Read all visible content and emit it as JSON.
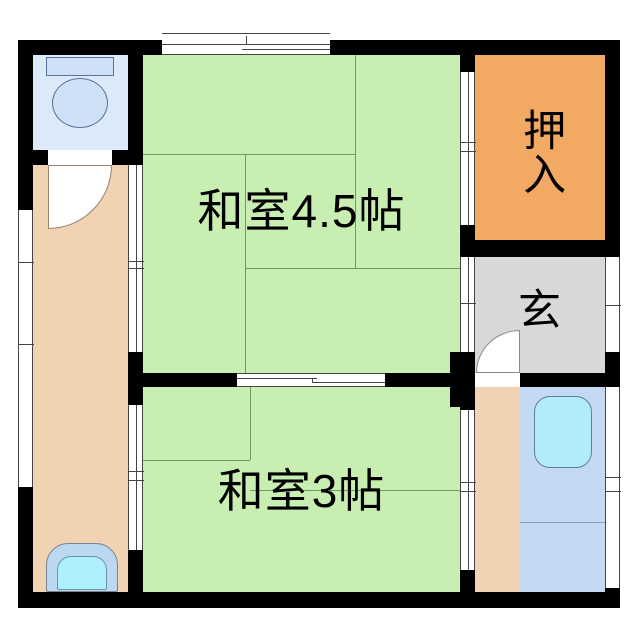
{
  "plan": {
    "type": "floor-plan",
    "rooms": {
      "washitsu45": {
        "label": "和室4.5帖"
      },
      "washitsu3": {
        "label": "和室3帖"
      },
      "oshiire": {
        "label": "押入"
      },
      "genkan": {
        "label": "玄"
      }
    },
    "colors": {
      "wall": "#000000",
      "tatami": "#c8eeb2",
      "tatami_line": "#6f9b63",
      "closet": "#f2a963",
      "entry": "#d8d8d8",
      "corridor": "#f1d2b2",
      "toilet_room": "#dce9f8",
      "kitchen": "#c3daf2",
      "kitchen_line": "#8aa0b8",
      "fixture_blue": "#cfe1f6",
      "fixture_border": "#55729c",
      "sink_cyan": "#b2ecf8",
      "sink_border": "#5b7f9e",
      "basin_outer": "#bcd7f2",
      "basin_inner": "#aeeffc",
      "arc_line": "#9a8269"
    }
  }
}
